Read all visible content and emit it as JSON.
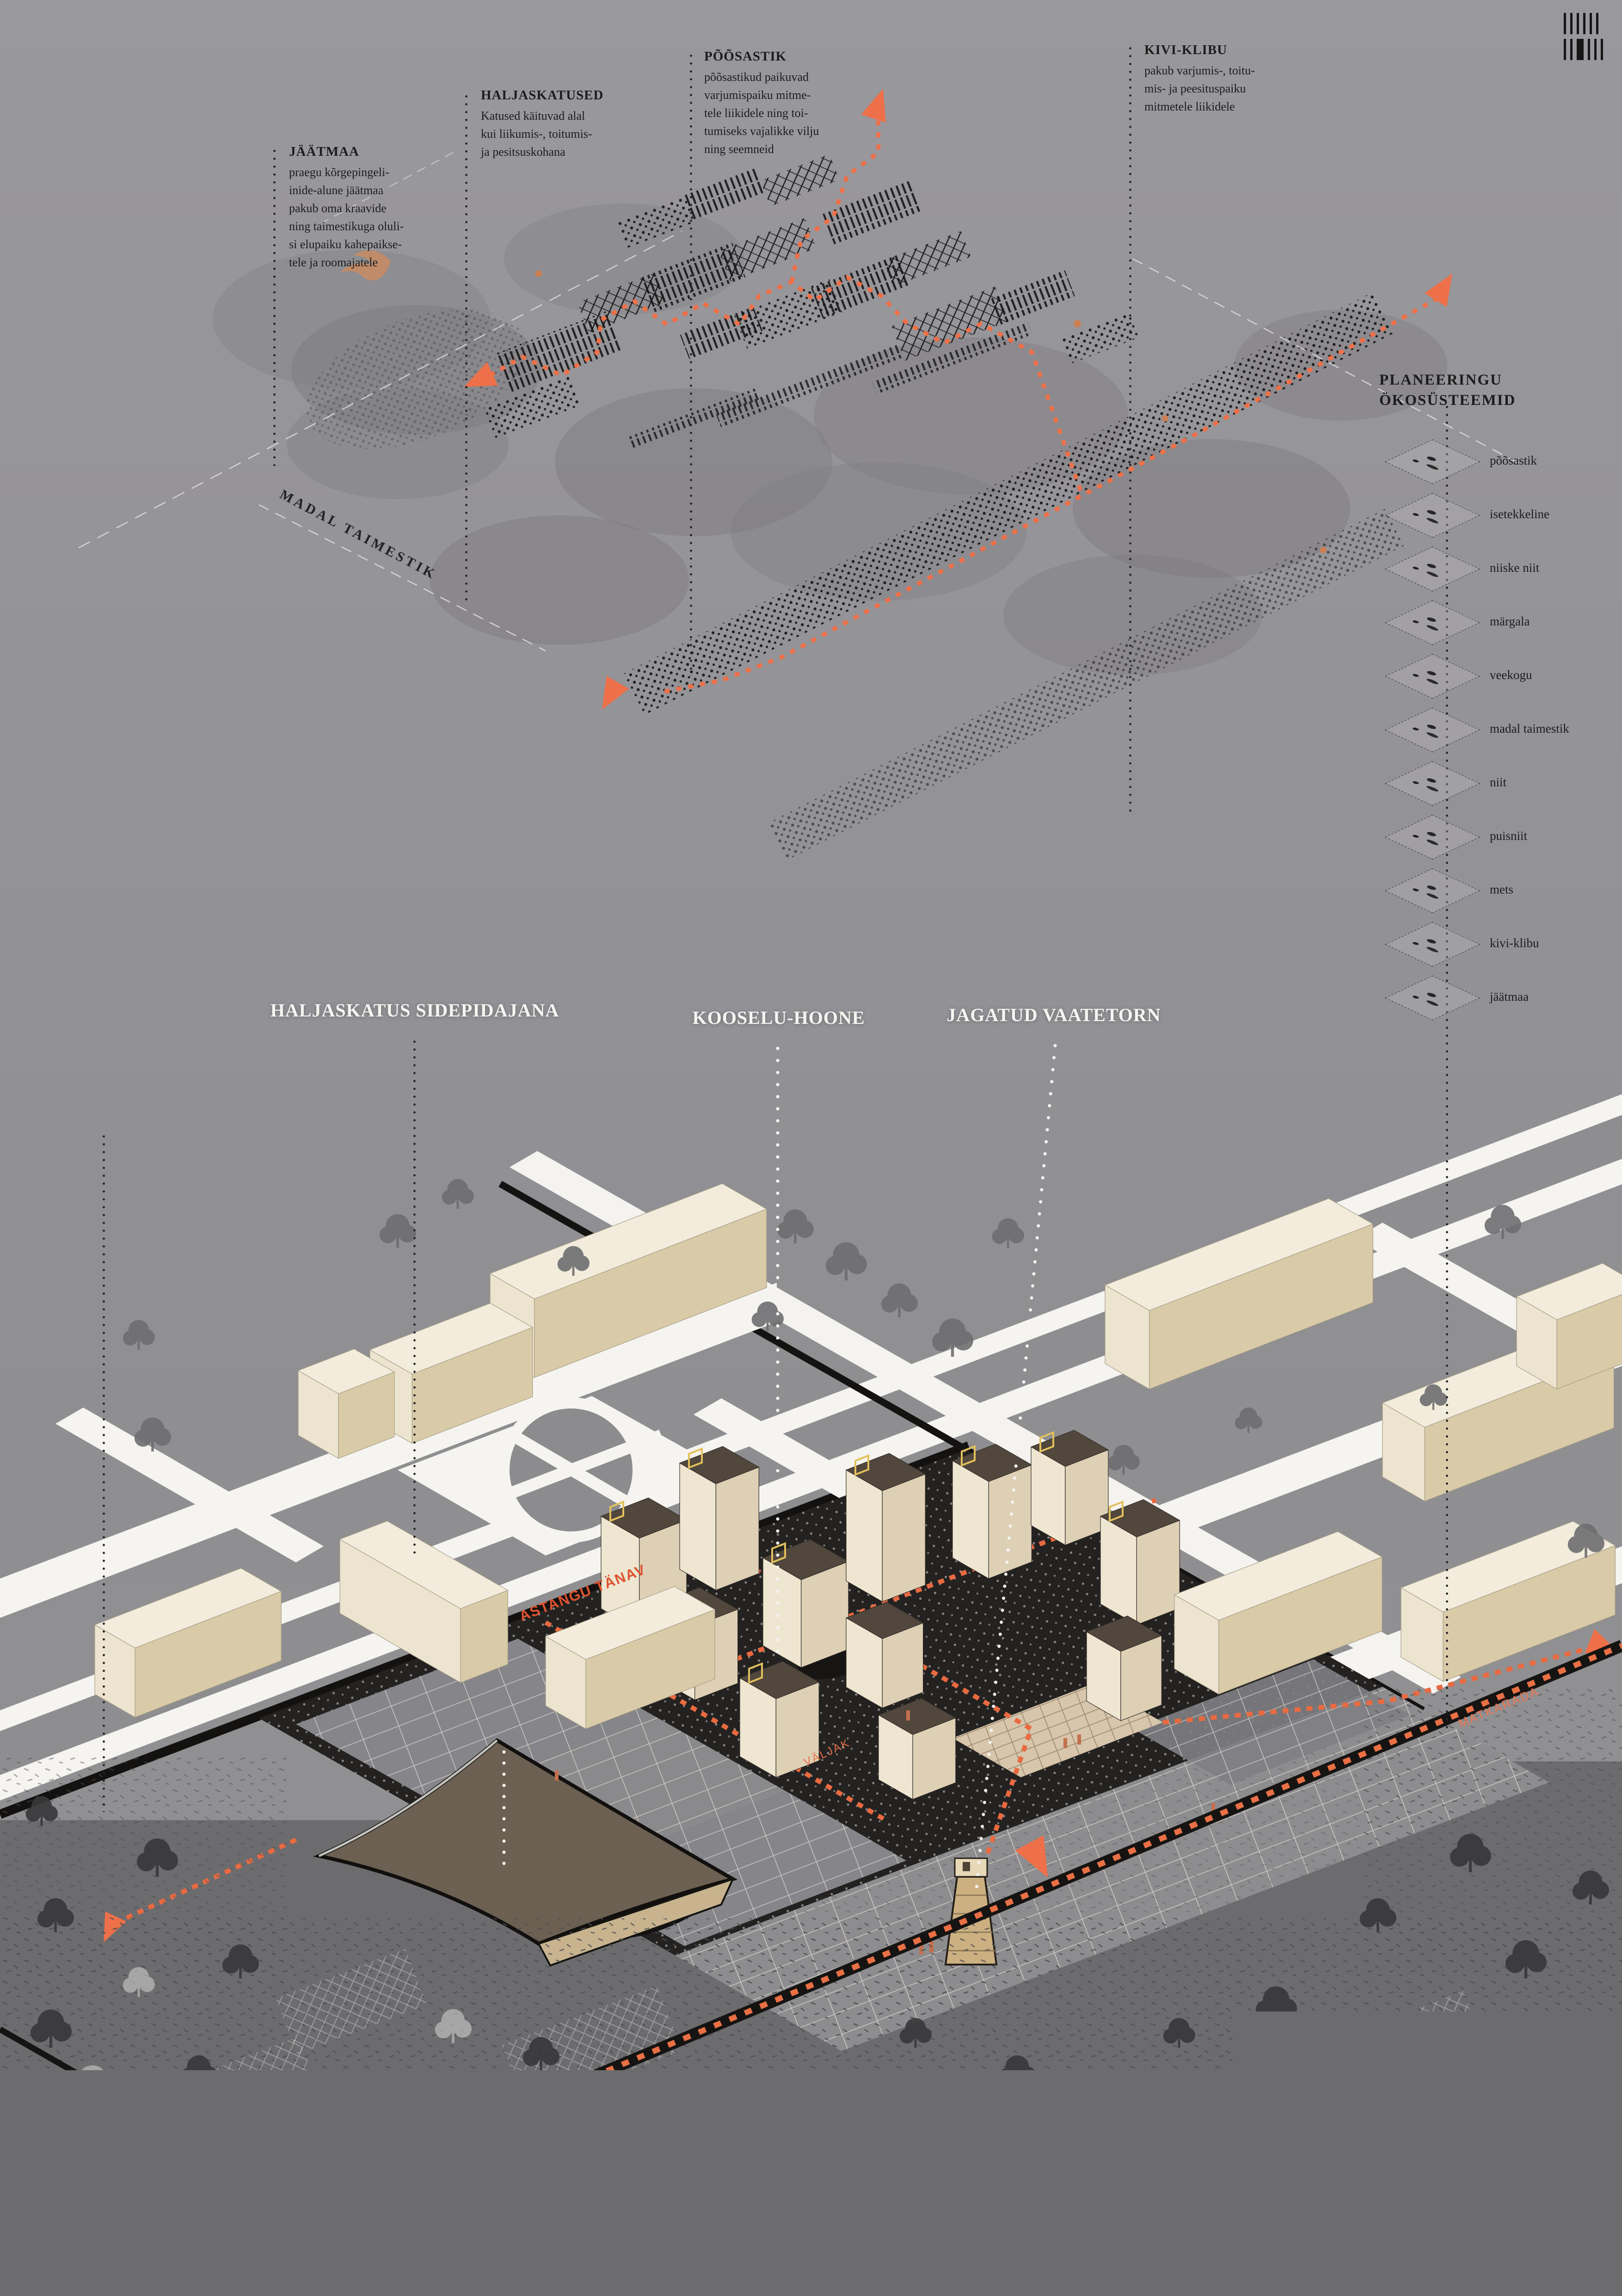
{
  "poster_colors": {
    "paper": "#97969a",
    "ink": "#1d1c1c",
    "accent_orange": "#e4613a",
    "accent_orange_light": "#ee7a52",
    "cream_building": "#f1ead9",
    "site_dark": "#232221",
    "canopy_brown": "#6b6052",
    "frame_yellow": "#e2c05b"
  },
  "annotations": [
    {
      "title": "JÄÄTMAA",
      "body": "praegu kõrgepingeli-\ninide-alune jäätmaa\npakub oma kraavide\nning taimestikuga oluli-\nsi elupaiku kahepaikse-\ntele ja roomajatele"
    },
    {
      "title": "HALJASKATUSED",
      "body": "Katused käituvad alal\nkui liikumis-, toitumis-\nja pesitsuskohana"
    },
    {
      "title": "PÕÕSASTIK",
      "body": "põõsastikud paikuvad\nvarjumispaiku mitme-\ntele liikidele ning toi-\ntumiseks vajalikke vilju\nning seemneid"
    },
    {
      "title": "KIVI-KLIBU",
      "body": "pakub varjumis-, toitu-\nmis- ja peesituspaiku\nmitmetele liikidele"
    }
  ],
  "sketch_label": "MADAL TAIMESTIK",
  "legend": {
    "title": "PLANEERINGU\nÖKOSÜSTEEMID",
    "items": [
      "põõsastik",
      "isetekkeline",
      "niiske niit",
      "märgala",
      "veekogu",
      "madal taimestik",
      "niit",
      "puisniit",
      "mets",
      "kivi-klibu",
      "jäätmaa"
    ]
  },
  "callouts": {
    "left": "HALJASKATUS SIDEPIDAJANA",
    "center": "KOOSELU-HOONE",
    "right": "JAGATUD VAATETORN"
  },
  "site_labels": {
    "street": "ASTANGU TÄNAV",
    "plaza": "VÄLJAK",
    "trail_left": "MATKARADA",
    "trail_right": "MATKARADA"
  }
}
